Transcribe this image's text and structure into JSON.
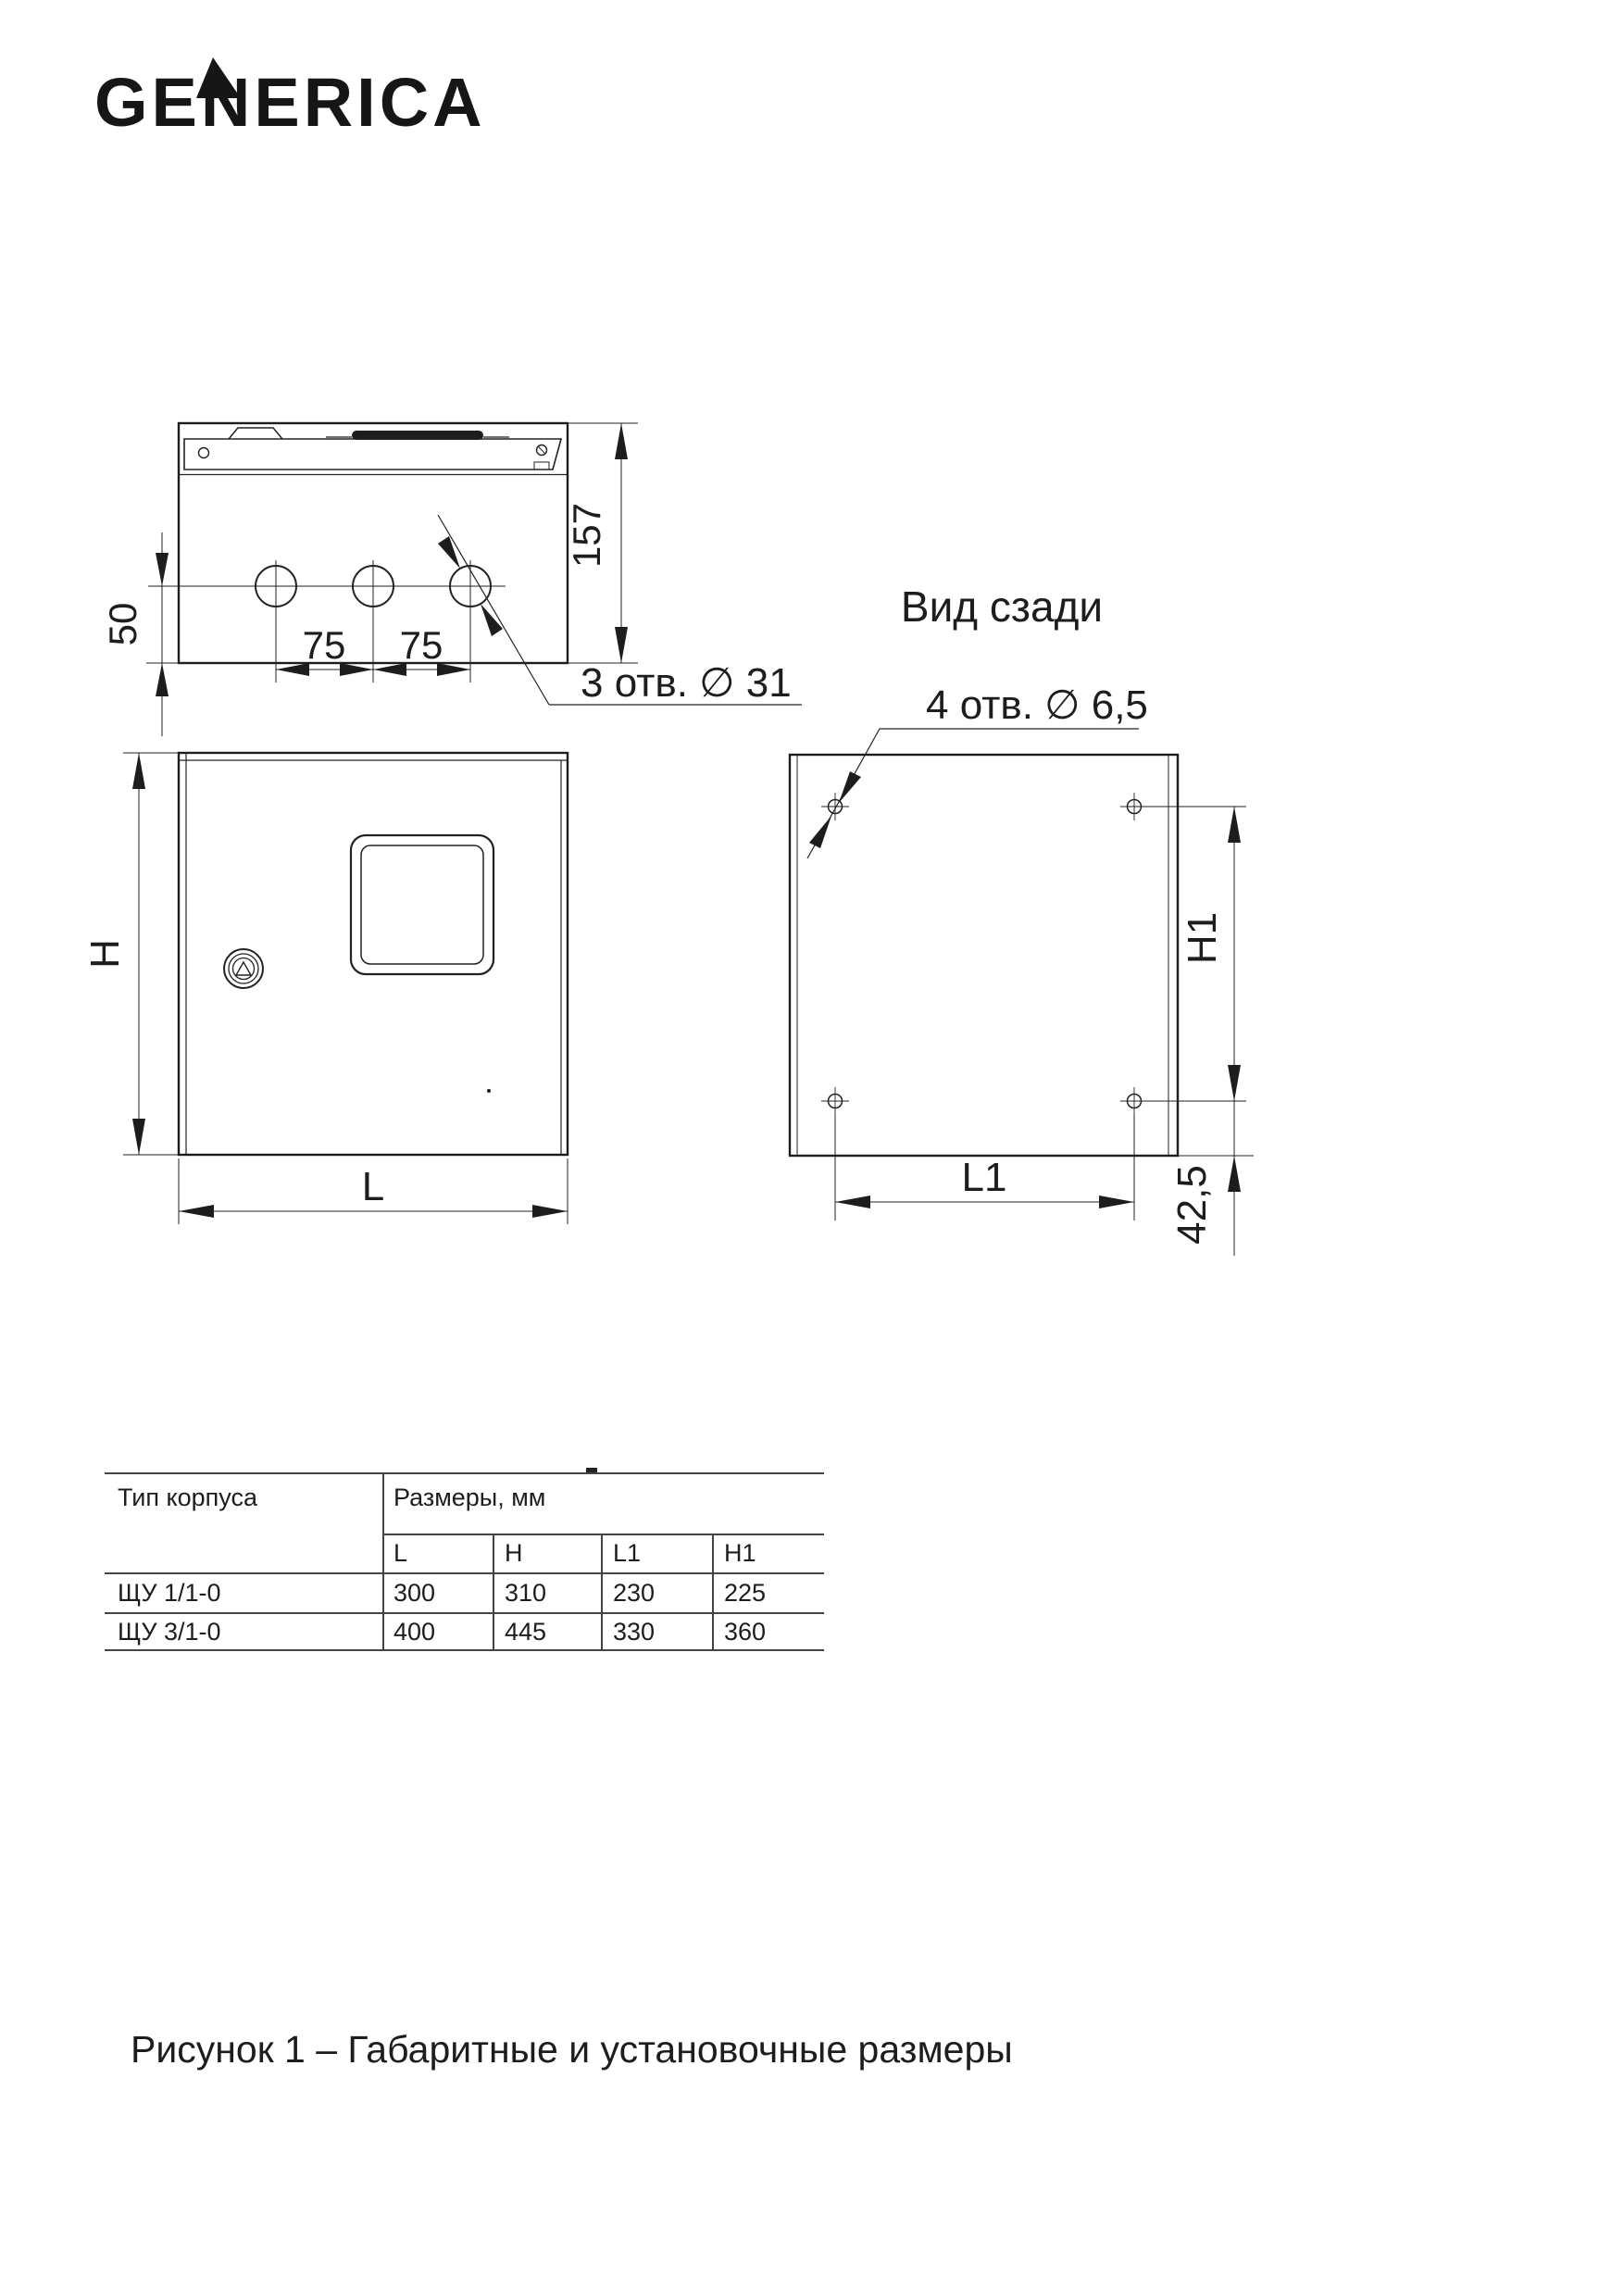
{
  "logo": {
    "text": "GENERICA"
  },
  "drawing": {
    "top_view": {
      "dim_depth": "157",
      "dim_hole_offset": "50",
      "dim_spacing_1": "75",
      "dim_spacing_2": "75",
      "holes_label": "3 отв. ∅ 31"
    },
    "front_view": {
      "dim_height": "H",
      "dim_width": "L"
    },
    "rear_view": {
      "view_title": "Вид сзади",
      "holes_label": "4 отв. ∅ 6,5",
      "dim_h1": "H1",
      "dim_l1": "L1",
      "dim_bottom_offset": "42,5"
    }
  },
  "table": {
    "col_type_header": "Тип корпуса",
    "col_sizes_header": "Размеры, мм",
    "sub_headers": [
      "L",
      "H",
      "L1",
      "H1"
    ],
    "rows": [
      {
        "type": "ЩУ 1/1-0",
        "values": [
          "300",
          "310",
          "230",
          "225"
        ]
      },
      {
        "type": "ЩУ 3/1-0",
        "values": [
          "400",
          "445",
          "330",
          "360"
        ]
      }
    ]
  },
  "caption": "Рисунок 1 – Габаритные и установочные размеры",
  "colors": {
    "line": "#222222",
    "text": "#1d1d1d"
  }
}
